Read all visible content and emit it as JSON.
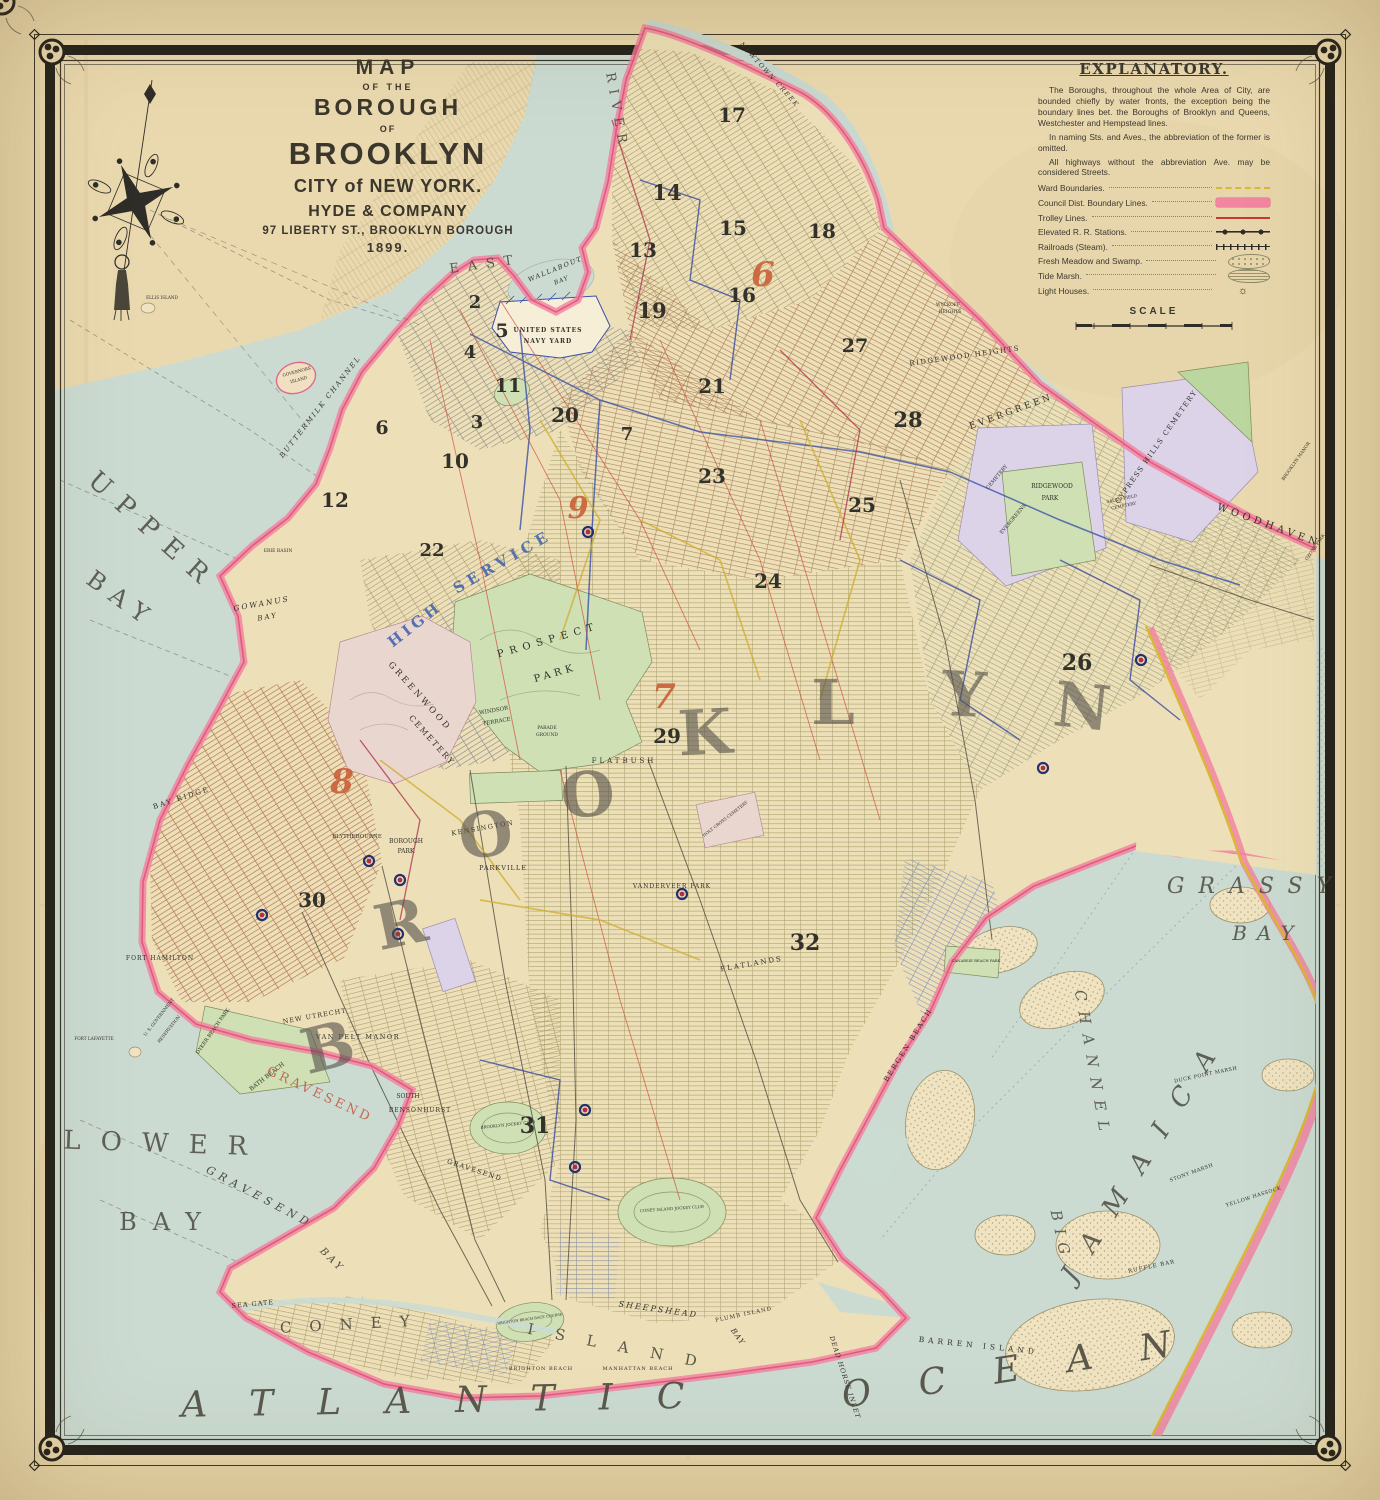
{
  "title_block": {
    "lines": [
      {
        "text": "MAP",
        "cls": "tl-1"
      },
      {
        "text": "OF THE",
        "cls": "tl-2"
      },
      {
        "text": "BOROUGH",
        "cls": "tl-3"
      },
      {
        "text": "OF",
        "cls": "tl-4"
      },
      {
        "text": "BROOKLYN",
        "cls": "tl-5"
      },
      {
        "text": "CITY of NEW YORK.",
        "cls": "tl-6"
      },
      {
        "text": "HYDE & COMPANY",
        "cls": "tl-7"
      },
      {
        "text": "97 LIBERTY ST., BROOKLYN BOROUGH",
        "cls": "tl-8"
      },
      {
        "text": "1899.",
        "cls": "tl-9"
      }
    ]
  },
  "explanatory": {
    "title": "EXPLANATORY.",
    "paragraphs": [
      "The Boroughs, throughout the whole Area of City, are bounded chiefly by water fronts, the exception being the boundary lines bet. the Boroughs of Brooklyn and Queens, Westchester and Hempstead lines.",
      "In naming Sts. and Aves., the abbreviation of the former is omitted.",
      "All highways without the abbreviation Ave. may be considered Streets."
    ],
    "legend": [
      {
        "label": "Ward Boundaries.",
        "type": "ward"
      },
      {
        "label": "Council Dist. Boundary Lines.",
        "type": "council"
      },
      {
        "label": "Trolley Lines.",
        "type": "trolley"
      },
      {
        "label": "Elevated R. R. Stations.",
        "type": "elevated"
      },
      {
        "label": "Railroads (Steam).",
        "type": "railroad"
      },
      {
        "label": "Fresh Meadow and Swamp.",
        "type": "swamp"
      },
      {
        "label": "Tide Marsh.",
        "type": "marsh"
      },
      {
        "label": "Light Houses.",
        "type": "lighthouse",
        "glyph": "☼"
      }
    ],
    "scale_label": "SCALE"
  },
  "map": {
    "labels": [
      {
        "t": "UPPER",
        "x": 148,
        "y": 538,
        "r": 42,
        "s": 26,
        "sp": 14,
        "c": "#4d4b40",
        "o": 0.85
      },
      {
        "t": "BAY",
        "x": 117,
        "y": 606,
        "r": 36,
        "s": 24,
        "sp": 10,
        "c": "#4d4b40",
        "o": 0.85
      },
      {
        "t": "LOWER",
        "x": 165,
        "y": 1152,
        "r": 2,
        "s": 26,
        "sp": 20,
        "c": "#4d4b40",
        "o": 0.85
      },
      {
        "t": "BAY",
        "x": 168,
        "y": 1230,
        "r": 0,
        "s": 24,
        "sp": 16,
        "c": "#4d4b40",
        "o": 0.85
      },
      {
        "t": "ATLANTIC",
        "x": 455,
        "y": 1412,
        "r": -1,
        "s": 36,
        "sp": 44,
        "i": 1,
        "c": "#4d4b40",
        "o": 0.9
      },
      {
        "t": "OCEAN",
        "x": 1032,
        "y": 1378,
        "r": -9,
        "s": 36,
        "sp": 48,
        "i": 1,
        "c": "#4d4b40",
        "o": 0.9
      },
      {
        "t": "GRASSY",
        "x": 1256,
        "y": 893,
        "r": 0,
        "s": 22,
        "sp": 14,
        "i": 1,
        "c": "#4d4b40",
        "o": 0.85
      },
      {
        "t": "BAY",
        "x": 1268,
        "y": 940,
        "r": 0,
        "s": 20,
        "sp": 10,
        "i": 1,
        "c": "#4d4b40",
        "o": 0.85
      },
      {
        "t": "JAMAICA",
        "x": 1152,
        "y": 1160,
        "r": -58,
        "s": 26,
        "sp": 24,
        "i": 1,
        "c": "#4d4b40",
        "o": 0.85
      },
      {
        "t": "BIG",
        "x": 1056,
        "y": 1237,
        "r": 78,
        "s": 15,
        "sp": 8,
        "i": 1,
        "c": "#4d4b40",
        "o": 0.85
      },
      {
        "t": "CHANNEL",
        "x": 1088,
        "y": 1066,
        "r": 80,
        "s": 15,
        "sp": 10,
        "i": 1,
        "c": "#4d4b40",
        "o": 0.85
      },
      {
        "t": "GRAVESEND",
        "x": 258,
        "y": 1200,
        "r": 28,
        "s": 11,
        "sp": 5,
        "i": 1,
        "c": "#4d4b40"
      },
      {
        "t": "BAY",
        "x": 330,
        "y": 1262,
        "r": 45,
        "s": 10,
        "sp": 3,
        "i": 1,
        "c": "#4d4b40"
      },
      {
        "t": "GOWANUS",
        "x": 262,
        "y": 606,
        "r": -10,
        "s": 7.5,
        "sp": 2,
        "i": 1
      },
      {
        "t": "BAY",
        "x": 268,
        "y": 619,
        "r": -10,
        "s": 7,
        "sp": 2,
        "i": 1
      },
      {
        "t": "BUTTERMILK CHANNEL",
        "x": 322,
        "y": 408,
        "r": -52,
        "s": 7,
        "sp": 2,
        "i": 1
      },
      {
        "t": "EAST",
        "x": 486,
        "y": 268,
        "r": -8,
        "s": 13,
        "sp": 9,
        "c": "#4d4b40",
        "o": 0.9
      },
      {
        "t": "RIVER",
        "x": 613,
        "y": 112,
        "r": 80,
        "s": 13,
        "sp": 7,
        "c": "#4d4b40",
        "o": 0.9
      },
      {
        "t": "WALLABOUT",
        "x": 556,
        "y": 271,
        "r": -22,
        "s": 6.5,
        "sp": 1.5,
        "i": 1
      },
      {
        "t": "BAY",
        "x": 562,
        "y": 282,
        "r": -22,
        "s": 6,
        "sp": 1,
        "i": 1
      },
      {
        "t": "NEWTOWN CREEK",
        "x": 768,
        "y": 76,
        "r": 48,
        "s": 6.5,
        "sp": 1.5,
        "i": 1
      },
      {
        "t": "SHEEPSHEAD",
        "x": 658,
        "y": 1312,
        "r": 8,
        "s": 8,
        "sp": 2,
        "i": 1
      },
      {
        "t": "BAY",
        "x": 736,
        "y": 1338,
        "r": 55,
        "s": 7.5,
        "sp": 1,
        "i": 1
      },
      {
        "t": "DEAD HORSE INLET",
        "x": 843,
        "y": 1378,
        "r": 72,
        "s": 6.5,
        "sp": 1,
        "i": 1
      },
      {
        "t": "PLUMB ISLAND",
        "x": 744,
        "y": 1316,
        "r": -12,
        "s": 5.5,
        "sp": 1
      },
      {
        "t": "BARREN ISLAND",
        "x": 978,
        "y": 1348,
        "r": 6,
        "s": 7.5,
        "sp": 4
      },
      {
        "t": "RUFFLE BAR",
        "x": 1152,
        "y": 1268,
        "r": -12,
        "s": 5.5,
        "sp": 1
      },
      {
        "t": "YELLOW HASSOCK",
        "x": 1254,
        "y": 1198,
        "r": -18,
        "s": 5,
        "sp": 0.5
      },
      {
        "t": "DUCK POINT MARSH",
        "x": 1206,
        "y": 1076,
        "r": -12,
        "s": 5,
        "sp": 0.5
      },
      {
        "t": "STONY MARSH",
        "x": 1192,
        "y": 1174,
        "r": -20,
        "s": 5,
        "sp": 0.5
      },
      {
        "t": "ELLIS ISLAND",
        "x": 162,
        "y": 299,
        "s": 4.2
      },
      {
        "t": "GOVERNORS",
        "x": 297,
        "y": 373,
        "r": -15,
        "s": 4.2
      },
      {
        "t": "ISLAND",
        "x": 299,
        "y": 381,
        "r": -15,
        "s": 4.2
      },
      {
        "t": "FORT LAFAYETTE",
        "x": 94,
        "y": 1040,
        "s": 4.2
      },
      {
        "t": "ERIE BASIN",
        "x": 278,
        "y": 552,
        "s": 4.5
      },
      {
        "t": "UNITED STATES",
        "x": 548,
        "y": 332,
        "s": 6,
        "sp": 1,
        "w": 700
      },
      {
        "t": "NAVY YARD",
        "x": 548,
        "y": 343,
        "s": 6,
        "sp": 1,
        "w": 700
      },
      {
        "t": "U. S. GOVERNMENT",
        "x": 160,
        "y": 1018,
        "r": -52,
        "s": 4.4
      },
      {
        "t": "RESERVATION",
        "x": 170,
        "y": 1030,
        "r": -52,
        "s": 4.4
      },
      {
        "t": "FORT HAMILTON",
        "x": 160,
        "y": 960,
        "s": 6,
        "sp": 1
      },
      {
        "t": "BAY RIDGE",
        "x": 182,
        "y": 800,
        "r": -18,
        "s": 7,
        "sp": 2
      },
      {
        "t": "DYKER BEACH PARK",
        "x": 214,
        "y": 1032,
        "r": -55,
        "s": 5
      },
      {
        "t": "BATH BEACH",
        "x": 268,
        "y": 1078,
        "r": -38,
        "s": 6
      },
      {
        "t": "NEW UTRECHT",
        "x": 315,
        "y": 1018,
        "r": -10,
        "s": 6.5,
        "sp": 1
      },
      {
        "t": "VAN PELT MANOR",
        "x": 358,
        "y": 1039,
        "s": 6.5,
        "sp": 1.5
      },
      {
        "t": "SOUTH",
        "x": 408,
        "y": 1098,
        "s": 6
      },
      {
        "t": "BENSONHURST",
        "x": 420,
        "y": 1112,
        "s": 6,
        "sp": 1
      },
      {
        "t": "BLYTHEBOURNE",
        "x": 357,
        "y": 838,
        "s": 5.5
      },
      {
        "t": "BOROUGH",
        "x": 406,
        "y": 843,
        "s": 6
      },
      {
        "t": "PARK",
        "x": 406,
        "y": 853,
        "s": 6
      },
      {
        "t": "KENSINGTON",
        "x": 483,
        "y": 830,
        "r": -10,
        "s": 6.5,
        "sp": 1.5
      },
      {
        "t": "PARKVILLE",
        "x": 503,
        "y": 870,
        "s": 6.5,
        "sp": 1
      },
      {
        "t": "WINDSOR",
        "x": 494,
        "y": 712,
        "r": -10,
        "s": 5.5
      },
      {
        "t": "TERRACE",
        "x": 497,
        "y": 723,
        "r": -10,
        "s": 5.5
      },
      {
        "t": "PARADE",
        "x": 547,
        "y": 729,
        "s": 4.5
      },
      {
        "t": "GROUND",
        "x": 547,
        "y": 736,
        "s": 4.5
      },
      {
        "t": "GREENWOOD",
        "x": 418,
        "y": 698,
        "r": 48,
        "s": 8.5,
        "sp": 3
      },
      {
        "t": "CEMETERY",
        "x": 430,
        "y": 742,
        "r": 48,
        "s": 8,
        "sp": 2
      },
      {
        "t": "PROSPECT",
        "x": 549,
        "y": 643,
        "r": -16,
        "s": 10,
        "sp": 6
      },
      {
        "t": "PARK",
        "x": 556,
        "y": 676,
        "r": -16,
        "s": 10,
        "sp": 4
      },
      {
        "t": "FLATBUSH",
        "x": 624,
        "y": 763,
        "s": 7,
        "sp": 3
      },
      {
        "t": "HOLY CROSS CEMETERY",
        "x": 726,
        "y": 820,
        "r": -38,
        "s": 4.2
      },
      {
        "t": "VANDERVEER PARK",
        "x": 672,
        "y": 888,
        "s": 6,
        "sp": 1
      },
      {
        "t": "FLATLANDS",
        "x": 752,
        "y": 966,
        "r": -10,
        "s": 7,
        "sp": 2
      },
      {
        "t": "BERGEN BEACH",
        "x": 910,
        "y": 1046,
        "r": -58,
        "s": 7,
        "sp": 2
      },
      {
        "t": "CANARSIE BEACH PARK",
        "x": 976,
        "y": 962,
        "s": 3.8
      },
      {
        "t": "SEA GATE",
        "x": 253,
        "y": 1306,
        "r": -5,
        "s": 6.5,
        "sp": 1
      },
      {
        "t": "BRIGHTON BEACH",
        "x": 541,
        "y": 1370,
        "s": 5,
        "sp": 1
      },
      {
        "t": "MANHATTAN BEACH",
        "x": 638,
        "y": 1370,
        "s": 5,
        "sp": 1
      },
      {
        "t": "CONEY",
        "x": 354,
        "y": 1329,
        "r": -3,
        "s": 15,
        "sp": 18,
        "c": "#4d4b40",
        "o": 0.9
      },
      {
        "t": "ISLAND",
        "x": 622,
        "y": 1352,
        "r": 11,
        "s": 15,
        "sp": 22,
        "c": "#4d4b40",
        "o": 0.9
      },
      {
        "t": "BROOKLYN JOCKEY CLUB",
        "x": 508,
        "y": 1126,
        "r": -6,
        "s": 4
      },
      {
        "t": "CONEY ISLAND JOCKEY CLUB",
        "x": 672,
        "y": 1210,
        "r": -4,
        "s": 4
      },
      {
        "t": "BRIGHTON BEACH RACE COURSE",
        "x": 530,
        "y": 1320,
        "r": -8,
        "s": 3.6
      },
      {
        "t": "RIDGEWOOD HEIGHTS",
        "x": 965,
        "y": 358,
        "r": -8,
        "s": 7,
        "sp": 1.5
      },
      {
        "t": "EVERGREEN",
        "x": 1012,
        "y": 414,
        "r": -20,
        "s": 9,
        "sp": 3
      },
      {
        "t": "CEMETERY",
        "x": 998,
        "y": 478,
        "r": -50,
        "s": 5
      },
      {
        "t": "EVERGREENS",
        "x": 1014,
        "y": 520,
        "r": -50,
        "s": 5
      },
      {
        "t": "RIDGEWOOD",
        "x": 1052,
        "y": 488,
        "s": 6
      },
      {
        "t": "PARK",
        "x": 1050,
        "y": 500,
        "s": 6
      },
      {
        "t": "CYPRESS HILLS CEMETERY",
        "x": 1158,
        "y": 448,
        "r": -55,
        "s": 7,
        "sp": 1.5
      },
      {
        "t": "SALEM FIELD",
        "x": 1122,
        "y": 500,
        "r": -12,
        "s": 4.2
      },
      {
        "t": "CEMETERY",
        "x": 1124,
        "y": 507,
        "r": -12,
        "s": 4.2
      },
      {
        "t": "WOODHAVEN",
        "x": 1268,
        "y": 528,
        "r": 20,
        "s": 10,
        "sp": 4
      },
      {
        "t": "BROOKLYN MANOR",
        "x": 1297,
        "y": 462,
        "r": -55,
        "s": 4.4
      },
      {
        "t": "OZONE PARK",
        "x": 1316,
        "y": 548,
        "r": -55,
        "s": 4.4
      },
      {
        "t": "WYCKOFF",
        "x": 948,
        "y": 306,
        "s": 4.5
      },
      {
        "t": "HEIGHTS",
        "x": 950,
        "y": 313,
        "s": 4.5
      },
      {
        "t": "HIGH",
        "x": 418,
        "y": 628,
        "r": -38,
        "s": 15,
        "sp": 4,
        "c": "#3c5fae",
        "o": 0.85,
        "w": 700
      },
      {
        "t": "SERVICE",
        "x": 505,
        "y": 566,
        "r": -30,
        "s": 15,
        "sp": 5,
        "c": "#3c5fae",
        "o": 0.85,
        "w": 700
      },
      {
        "t": "GRAVESEND",
        "x": 318,
        "y": 1098,
        "r": 25,
        "s": 13,
        "sp": 3,
        "c": "#c05038",
        "o": 0.8
      },
      {
        "t": "GRAVESEND",
        "x": 474,
        "y": 1172,
        "r": 18,
        "s": 6.5,
        "sp": 1.5
      }
    ],
    "big_letters": [
      {
        "ch": "B",
        "x": 333,
        "y": 1068,
        "r": -14,
        "s": 62
      },
      {
        "ch": "R",
        "x": 405,
        "y": 945,
        "r": -12,
        "s": 62
      },
      {
        "ch": "O",
        "x": 489,
        "y": 856,
        "r": -9,
        "s": 62
      },
      {
        "ch": "O",
        "x": 590,
        "y": 816,
        "r": -6,
        "s": 62
      },
      {
        "ch": "K",
        "x": 706,
        "y": 754,
        "r": -3,
        "s": 62
      },
      {
        "ch": "L",
        "x": 833,
        "y": 724,
        "r": 0,
        "s": 62
      },
      {
        "ch": "Y",
        "x": 963,
        "y": 716,
        "r": 3,
        "s": 62
      },
      {
        "ch": "N",
        "x": 1080,
        "y": 728,
        "r": 6,
        "s": 62
      }
    ],
    "ward_numbers": [
      {
        "t": "2",
        "x": 475,
        "y": 308,
        "s": 18
      },
      {
        "t": "5",
        "x": 502,
        "y": 337,
        "s": 19
      },
      {
        "t": "4",
        "x": 470,
        "y": 358,
        "s": 18
      },
      {
        "t": "11",
        "x": 508,
        "y": 392,
        "s": 19
      },
      {
        "t": "20",
        "x": 565,
        "y": 422,
        "s": 20
      },
      {
        "t": "3",
        "x": 477,
        "y": 428,
        "s": 18
      },
      {
        "t": "10",
        "x": 455,
        "y": 468,
        "s": 20
      },
      {
        "t": "6",
        "x": 382,
        "y": 434,
        "s": 19
      },
      {
        "t": "12",
        "x": 335,
        "y": 507,
        "s": 20
      },
      {
        "t": "7",
        "x": 627,
        "y": 440,
        "s": 18
      },
      {
        "t": "13",
        "x": 643,
        "y": 257,
        "s": 20
      },
      {
        "t": "17",
        "x": 732,
        "y": 122,
        "s": 20
      },
      {
        "t": "14",
        "x": 667,
        "y": 200,
        "s": 21
      },
      {
        "t": "15",
        "x": 733,
        "y": 235,
        "s": 20
      },
      {
        "t": "18",
        "x": 822,
        "y": 238,
        "s": 20
      },
      {
        "t": "16",
        "x": 742,
        "y": 302,
        "s": 20
      },
      {
        "t": "19",
        "x": 652,
        "y": 318,
        "s": 21
      },
      {
        "t": "21",
        "x": 712,
        "y": 393,
        "s": 20
      },
      {
        "t": "22",
        "x": 432,
        "y": 556,
        "s": 18
      },
      {
        "t": "28",
        "x": 908,
        "y": 427,
        "s": 21
      },
      {
        "t": "27",
        "x": 855,
        "y": 352,
        "s": 19
      },
      {
        "t": "23",
        "x": 712,
        "y": 483,
        "s": 20
      },
      {
        "t": "25",
        "x": 862,
        "y": 512,
        "s": 20
      },
      {
        "t": "24",
        "x": 768,
        "y": 588,
        "s": 20
      },
      {
        "t": "26",
        "x": 1077,
        "y": 670,
        "s": 22
      },
      {
        "t": "29",
        "x": 667,
        "y": 743,
        "s": 20
      },
      {
        "t": "30",
        "x": 312,
        "y": 907,
        "s": 20
      },
      {
        "t": "31",
        "x": 535,
        "y": 1133,
        "s": 22
      },
      {
        "t": "32",
        "x": 805,
        "y": 950,
        "s": 22
      }
    ],
    "council_numbers": [
      {
        "t": "6",
        "x": 763,
        "y": 286,
        "s": 34
      },
      {
        "t": "7",
        "x": 664,
        "y": 708,
        "s": 34
      },
      {
        "t": "8",
        "x": 342,
        "y": 793,
        "s": 34
      },
      {
        "t": "9",
        "x": 578,
        "y": 518,
        "s": 30
      }
    ],
    "stations": [
      {
        "x": 588,
        "y": 532
      },
      {
        "x": 1141,
        "y": 660
      },
      {
        "x": 1043,
        "y": 768
      },
      {
        "x": 682,
        "y": 894
      },
      {
        "x": 369,
        "y": 861
      },
      {
        "x": 400,
        "y": 880
      },
      {
        "x": 262,
        "y": 915
      },
      {
        "x": 398,
        "y": 934
      },
      {
        "x": 585,
        "y": 1110
      },
      {
        "x": 575,
        "y": 1167
      }
    ]
  },
  "colors": {
    "paper": "#e8d8ad",
    "water": "#cbdbd2",
    "land": "#ede0b8",
    "council_pink": "#f27fa0",
    "ward_yellow": "#d9b832",
    "ink": "#2f2d28"
  }
}
